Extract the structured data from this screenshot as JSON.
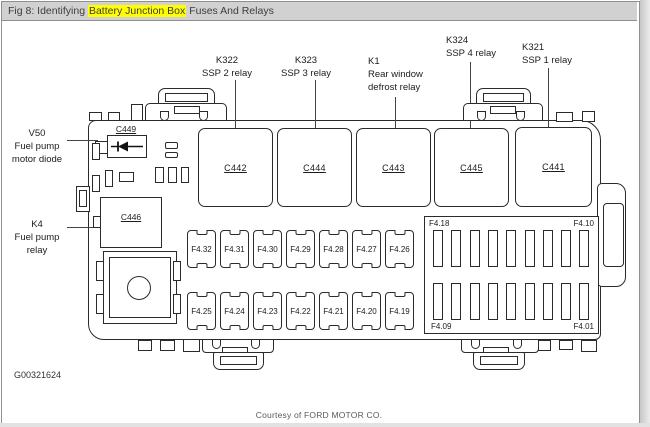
{
  "window": {
    "titlebar": {
      "prefix": "Fig 8: Identifying ",
      "highlight": "Battery Junction Box",
      "suffix": " Fuses And Relays",
      "highlight_color": "#ffff00",
      "bg_color": "#d2d1d1"
    }
  },
  "callouts": {
    "k322": {
      "line1": "K322",
      "line2": "SSP 2 relay"
    },
    "k323": {
      "line1": "K323",
      "line2": "SSP 3 relay"
    },
    "k1": {
      "line1": "K1",
      "line2": "Rear window",
      "line3": "defrost relay"
    },
    "k324": {
      "line1": "K324",
      "line2": "SSP 4 relay"
    },
    "k321": {
      "line1": "K321",
      "line2": "SSP 1 relay"
    },
    "v50": {
      "line1": "V50",
      "line2": "Fuel pump",
      "line3": "motor diode"
    },
    "k4": {
      "line1": "K4",
      "line2": "Fuel pump",
      "line3": "relay"
    }
  },
  "connectors": {
    "c449": "C449",
    "c442": "C442",
    "c444": "C444",
    "c443": "C443",
    "c445": "C445",
    "c441": "C441",
    "c446": "C446"
  },
  "fuses": {
    "row1": [
      "F4.32",
      "F4.31",
      "F4.30",
      "F4.29",
      "F4.28",
      "F4.27",
      "F4.26"
    ],
    "row2": [
      "F4.25",
      "F4.24",
      "F4.23",
      "F4.22",
      "F4.21",
      "F4.20",
      "F4.19"
    ]
  },
  "right_panel": {
    "corner_labels": {
      "top_left": "F4.18",
      "top_right": "F4.10",
      "bottom_left": "F4.09",
      "bottom_right": "F4.01"
    },
    "rows": 2,
    "slots_per_row": 9
  },
  "footer": {
    "figure_id": "G00321624",
    "courtesy": "Courtesy of FORD MOTOR CO."
  },
  "colors": {
    "line": "#2b2b2b",
    "text": "#1c1c1c"
  }
}
